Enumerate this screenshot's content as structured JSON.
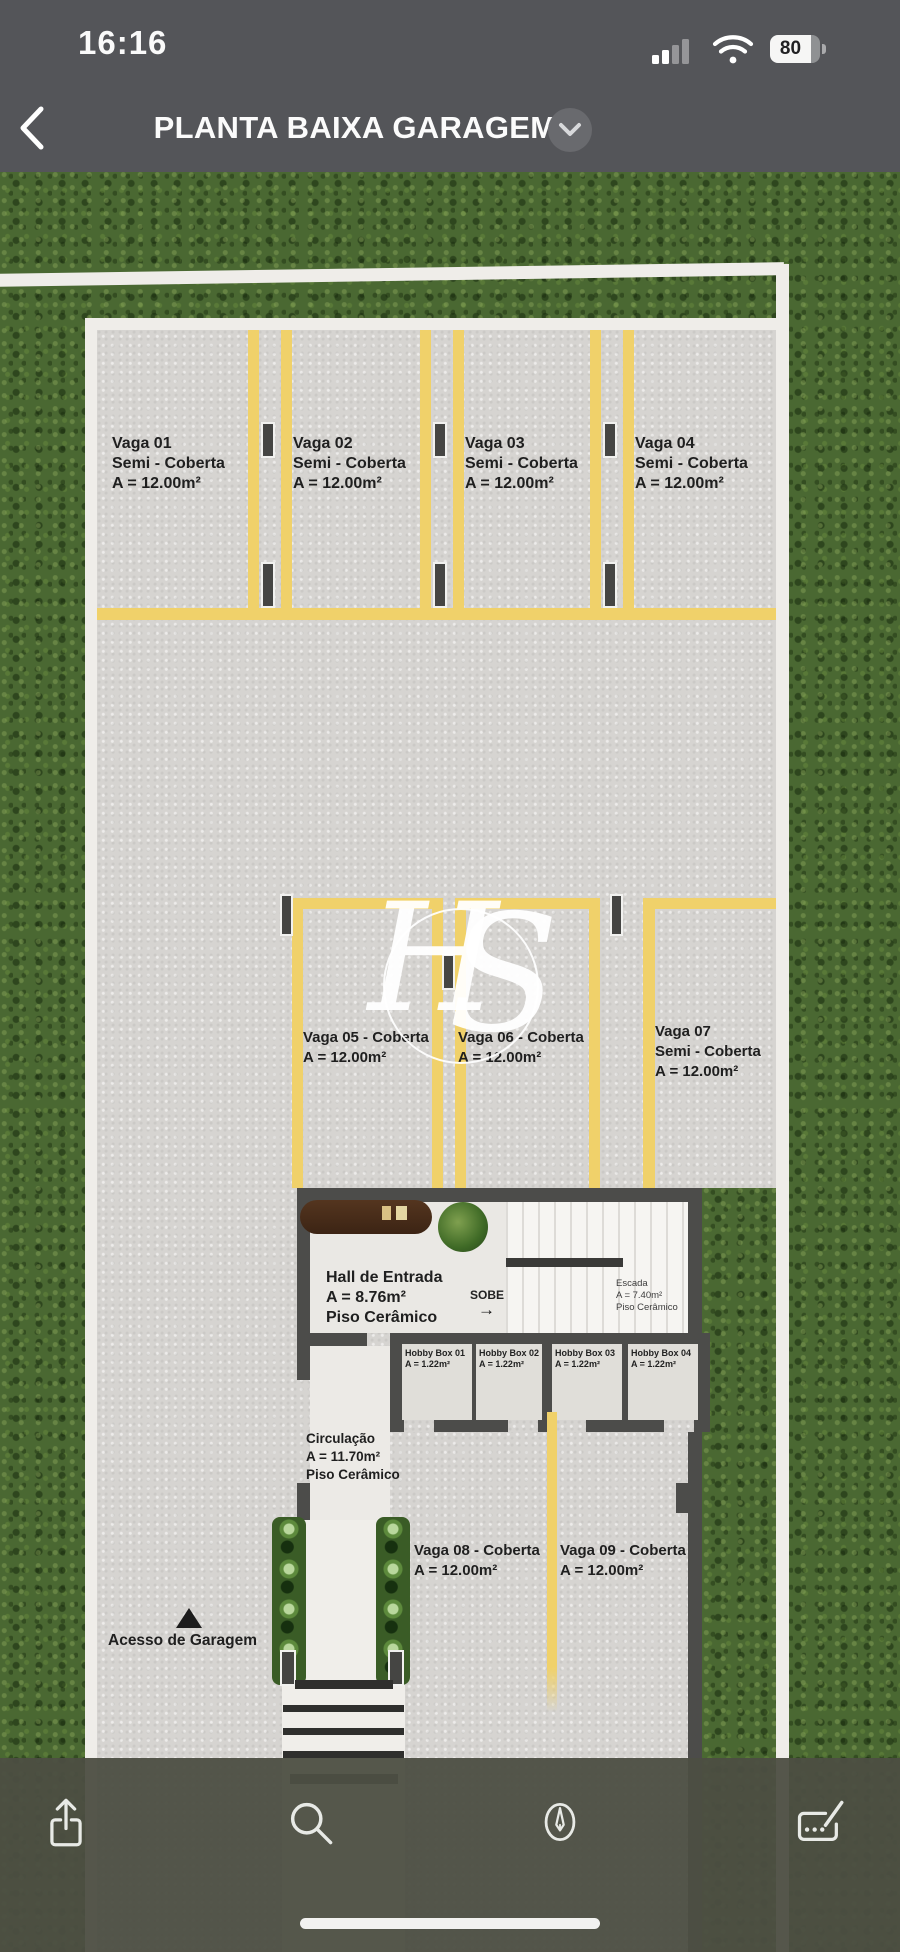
{
  "status_bar": {
    "time": "16:16",
    "battery_percent": "80"
  },
  "nav": {
    "title": "PLANTA BAIXA GARAGEM"
  },
  "plan": {
    "watermark_h": "H",
    "watermark_s": "S",
    "stalls_row1": [
      {
        "name": "Vaga 01",
        "type": "Semi - Coberta",
        "area": "A = 12.00m²"
      },
      {
        "name": "Vaga 02",
        "type": "Semi - Coberta",
        "area": "A = 12.00m²"
      },
      {
        "name": "Vaga 03",
        "type": "Semi - Coberta",
        "area": "A = 12.00m²"
      },
      {
        "name": "Vaga 04",
        "type": "Semi - Coberta",
        "area": "A = 12.00m²"
      }
    ],
    "stalls_row2": [
      {
        "name": "Vaga 05 - Coberta",
        "area": "A = 12.00m²"
      },
      {
        "name": "Vaga 06 - Coberta",
        "area": "A = 12.00m²"
      }
    ],
    "stall7": {
      "name": "Vaga 07",
      "type": "Semi - Coberta",
      "area": "A = 12.00m²"
    },
    "hall": {
      "name": "Hall de Entrada",
      "area": "A = 8.76m²",
      "floor": "Piso Cerâmico"
    },
    "sobe_label": "SOBE",
    "sobe_arrow": "→",
    "escada": {
      "name": "Escada",
      "area": "A = 7.40m²",
      "floor": "Piso Cerâmico"
    },
    "hobby_boxes": [
      {
        "name": "Hobby Box 01",
        "area": "A = 1.22m²"
      },
      {
        "name": "Hobby Box 02",
        "area": "A = 1.22m²"
      },
      {
        "name": "Hobby Box 03",
        "area": "A = 1.22m²"
      },
      {
        "name": "Hobby Box 04",
        "area": "A = 1.22m²"
      }
    ],
    "circulacao": {
      "name": "Circulação",
      "area": "A = 11.70m²",
      "floor": "Piso Cerâmico"
    },
    "stalls_row3": [
      {
        "name": "Vaga 08 - Coberta",
        "area": "A = 12.00m²"
      },
      {
        "name": "Vaga 09 - Coberta",
        "area": "A = 12.00m²"
      }
    ],
    "access_label": "Acesso de Garagem"
  },
  "toolbar": {
    "icons": [
      "share",
      "search",
      "markup-pen",
      "signature"
    ]
  },
  "colors": {
    "header_bg": "#545559",
    "toolbar_bg": "#4c4e42",
    "grass": "#4a6832",
    "concrete": "#d6d4d1",
    "stripe_yellow": "#f0d16a",
    "wall_dark": "#4c4c4a",
    "wall_white": "#efede9"
  }
}
